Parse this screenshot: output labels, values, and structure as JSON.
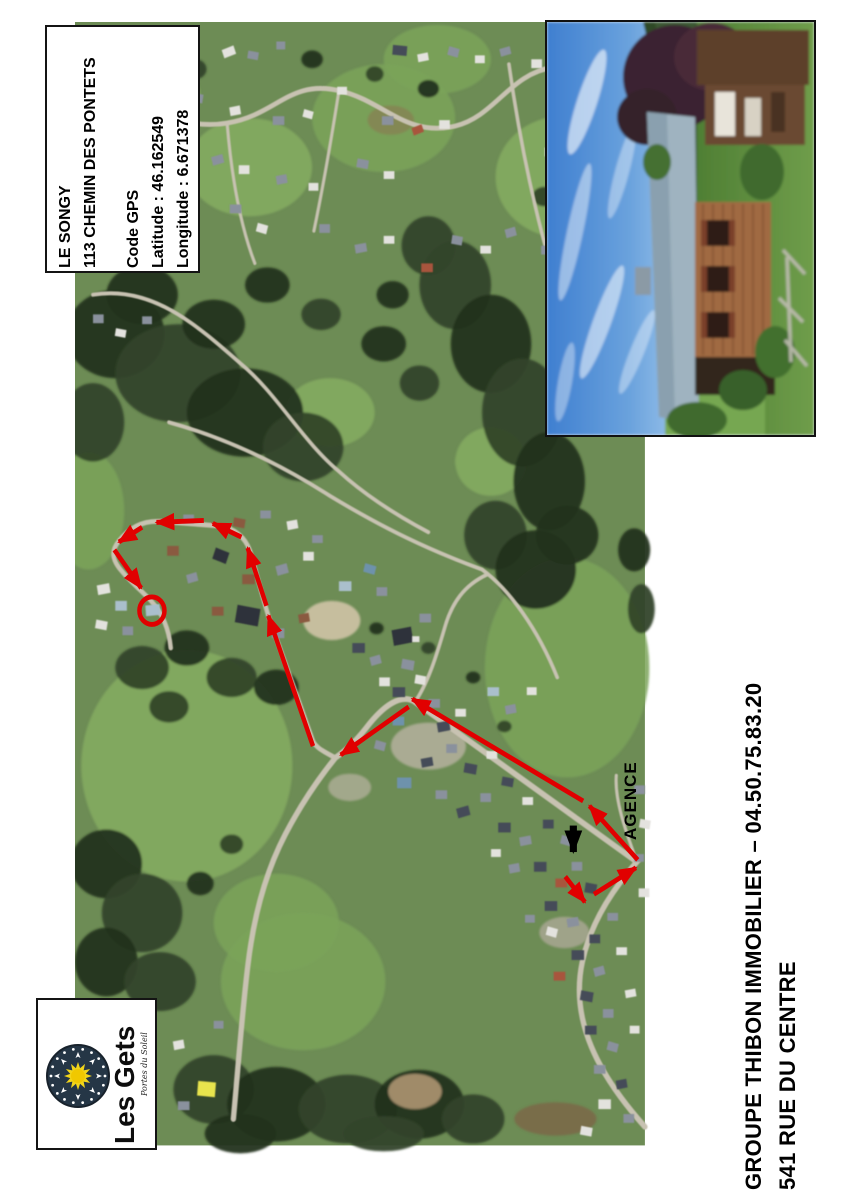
{
  "property_box": {
    "line1": "LE SONGY",
    "line2": "113 CHEMIN DES PONTETS",
    "gps_title": "Code GPS",
    "latitude": "Latitude : 46.162549",
    "longitude": "Longitude : 6.671378"
  },
  "agency": {
    "label": "AGENCE"
  },
  "footer": {
    "line1": "GROUPE THIBON IMMOBILIER – 04.50.75.83.20",
    "line2": "541 RUE DU CENTRE"
  },
  "logo": {
    "name": "Les Gets",
    "tagline": "Portes du Soleil"
  },
  "colors": {
    "route_red": "#e10000",
    "pointer_black": "#000000",
    "logo_navy": "#253646",
    "logo_sun_yellow": "#f2d51a"
  },
  "route": {
    "segments": [
      [
        623,
        893,
        645,
        919
      ],
      [
        655,
        911,
        702,
        884
      ],
      [
        704,
        876,
        650,
        821
      ],
      [
        643,
        816,
        452,
        712
      ],
      [
        448,
        720,
        372,
        769
      ],
      [
        341,
        760,
        291,
        627
      ],
      [
        289,
        617,
        268,
        558
      ],
      [
        261,
        547,
        229,
        533
      ],
      [
        219,
        530,
        166,
        532
      ],
      [
        150,
        537,
        124,
        552
      ],
      [
        119,
        560,
        149,
        599
      ]
    ],
    "destination_circle": [
      161,
      622,
      14
    ],
    "agency_pointer": [
      632,
      841,
      632,
      868
    ]
  }
}
